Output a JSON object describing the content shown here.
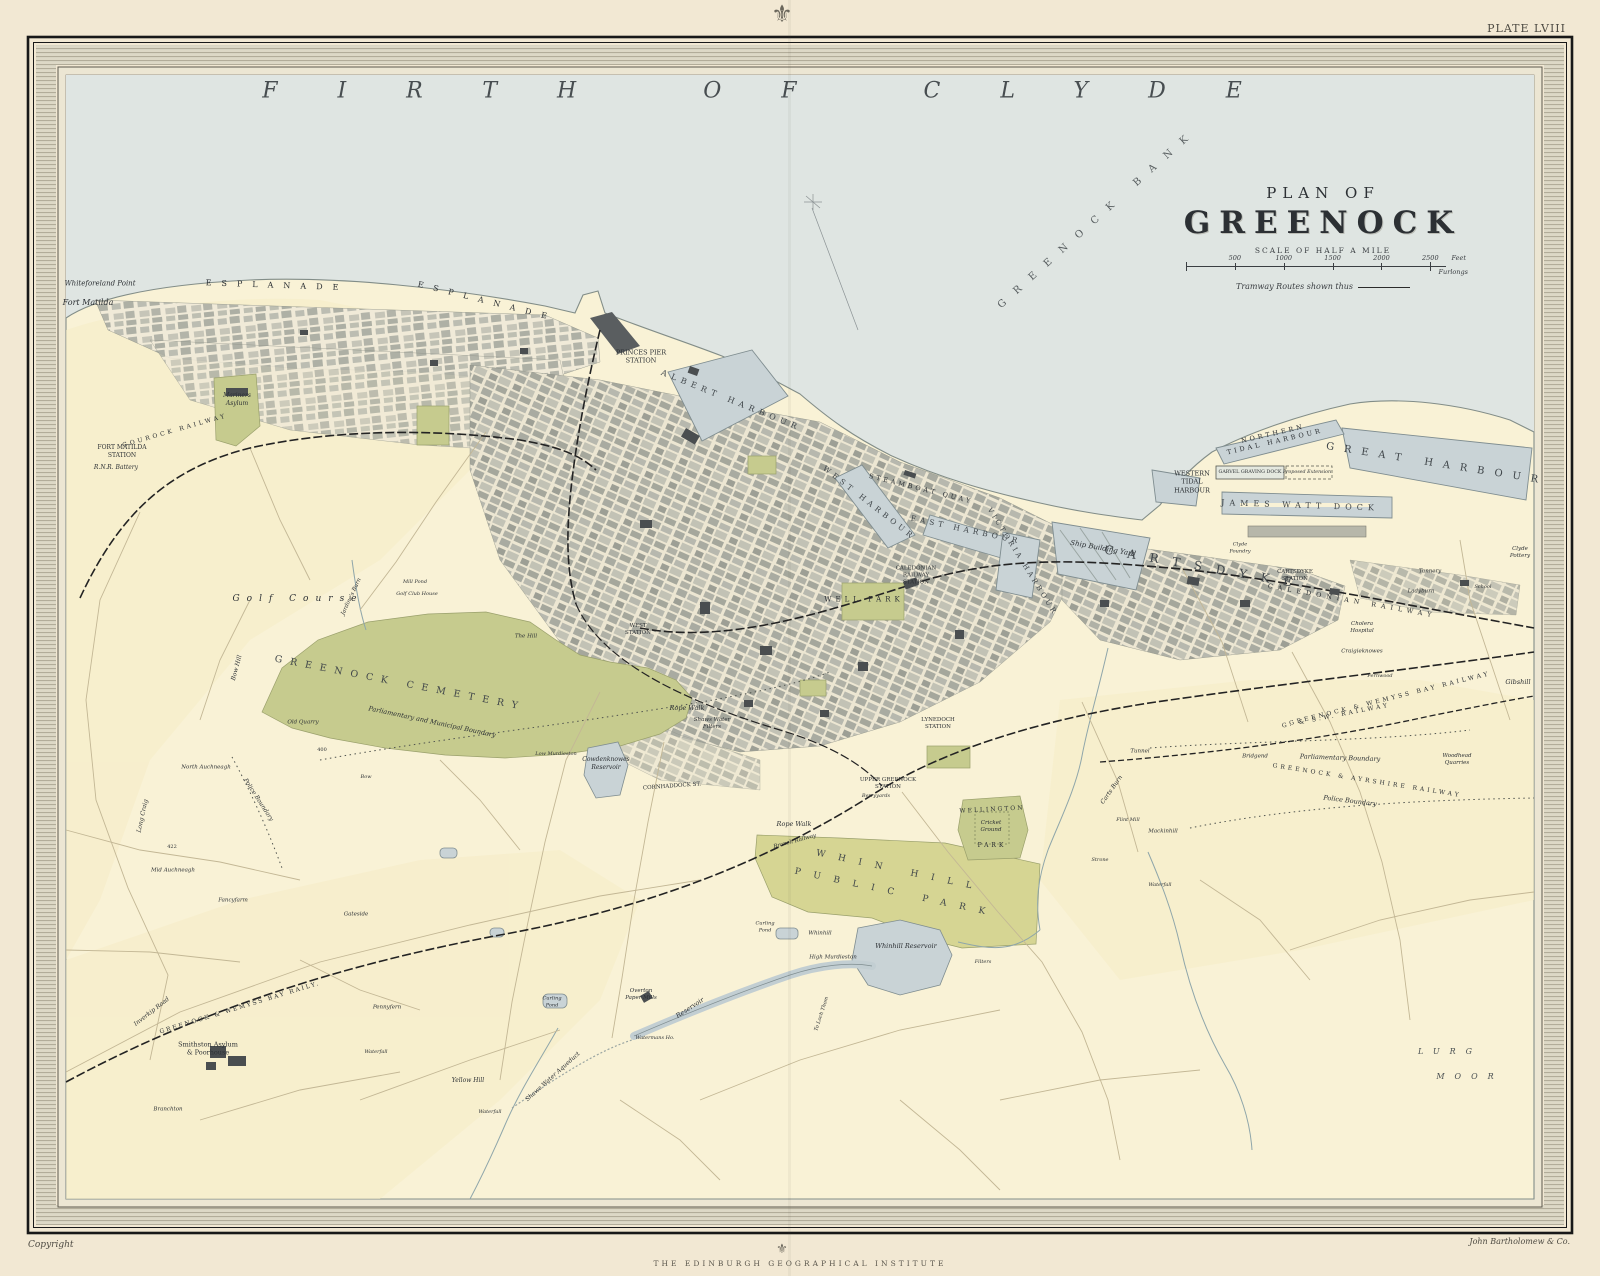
{
  "page": {
    "plate": "PLATE LVIII",
    "copyright": "Copyright",
    "publisher": "John Bartholomew & Co.",
    "institute": "THE EDINBURGH GEOGRAPHICAL INSTITUTE",
    "crest_glyph": "⚜"
  },
  "title": {
    "kicker": "PLAN OF",
    "name": "GREENOCK",
    "scale_caption": "SCALE OF HALF A MILE",
    "scale_ticks": [
      "500",
      "1000",
      "1500",
      "2000",
      "2500"
    ],
    "scale_unit_top": "Feet",
    "scale_unit_bottom": "Furlongs",
    "tramway_note": "Tramway Routes shown thus"
  },
  "colors": {
    "paper": "#f2e8d3",
    "margin_band": "#d8d3c1",
    "sea": "#dfe5e2",
    "land": "#f9f2d6",
    "land_warm": "#f6ecc6",
    "city_street": "#eee8d5",
    "green": "#c6cb8e",
    "green2": "#d6d593",
    "water": "#c9d3d6",
    "water_edge": "#7f8d90",
    "ink": "#2c3034",
    "ink_light": "#4a5052",
    "rail": "#232323",
    "road": "#c3b795"
  },
  "map": {
    "labels": [
      {
        "t": "FIRTH OF CLYDE",
        "x": 782,
        "y": 92,
        "s": 22,
        "ls": 60,
        "i": true,
        "c": "#474d50"
      },
      {
        "t": "GREENOCK BANK",
        "x": 1098,
        "y": 218,
        "s": 10,
        "ls": 13,
        "r": -42,
        "c": "#565c5e"
      },
      {
        "t": "Whiteforeland Point",
        "x": 100,
        "y": 284,
        "s": 7,
        "i": true
      },
      {
        "t": "Fort Matilda",
        "x": 88,
        "y": 303,
        "s": 8,
        "i": true
      },
      {
        "t": "ESPLANADE",
        "x": 277,
        "y": 286,
        "s": 8,
        "ls": 10,
        "r": 2
      },
      {
        "t": "ESPLANADE",
        "x": 487,
        "y": 302,
        "s": 8,
        "ls": 10,
        "r": 14
      },
      {
        "t": "Mariners|Asylum",
        "x": 237,
        "y": 400,
        "s": 6,
        "i": true
      },
      {
        "t": "FORT MATILDA|STATION",
        "x": 122,
        "y": 452,
        "s": 6
      },
      {
        "t": "R.N.R. Battery",
        "x": 116,
        "y": 468,
        "s": 6,
        "i": true
      },
      {
        "t": "GOUROCK RAILWAY",
        "x": 175,
        "y": 431,
        "s": 6,
        "ls": 3,
        "r": -16
      },
      {
        "t": "PRINCES PIER|STATION",
        "x": 641,
        "y": 357,
        "s": 6.5
      },
      {
        "t": "ALBERT HARBOUR",
        "x": 731,
        "y": 401,
        "s": 8,
        "ls": 5,
        "r": 22,
        "c": "#3f4549"
      },
      {
        "t": "WEST HARBOUR",
        "x": 869,
        "y": 503,
        "s": 7.5,
        "ls": 4,
        "r": 38,
        "c": "#3f4549"
      },
      {
        "t": "STEAMBOAT QUAY",
        "x": 921,
        "y": 489,
        "s": 6.5,
        "ls": 3,
        "r": 14
      },
      {
        "t": "EAST HARBOUR",
        "x": 966,
        "y": 530,
        "s": 7.5,
        "ls": 4,
        "r": 12,
        "c": "#3f4549"
      },
      {
        "t": "VICTORIA HARBOUR",
        "x": 1022,
        "y": 562,
        "s": 7,
        "ls": 3,
        "r": 58,
        "c": "#3f4549"
      },
      {
        "t": "CALEDONIAN|RAILWAY|STATION",
        "x": 916,
        "y": 576,
        "s": 5.5
      },
      {
        "t": "WELL PARK",
        "x": 864,
        "y": 600,
        "s": 7,
        "ls": 4
      },
      {
        "t": "Ship Building Yard",
        "x": 1103,
        "y": 549,
        "s": 7,
        "i": true,
        "r": 10
      },
      {
        "t": "CARTSDYKE",
        "x": 1205,
        "y": 568,
        "s": 12,
        "ls": 14,
        "r": 10,
        "c": "#3f4549"
      },
      {
        "t": "CARTSDYKE|STATION",
        "x": 1295,
        "y": 576,
        "s": 5.5
      },
      {
        "t": "CALEDONIAN RAILWAY",
        "x": 1352,
        "y": 601,
        "s": 6.5,
        "ls": 5,
        "r": 10
      },
      {
        "t": "JAMES WATT DOCK",
        "x": 1300,
        "y": 506,
        "s": 8,
        "ls": 5,
        "r": 2,
        "c": "#3f4549"
      },
      {
        "t": "GREAT HARBOUR",
        "x": 1437,
        "y": 464,
        "s": 10,
        "ls": 10,
        "r": 9,
        "c": "#3f4549"
      },
      {
        "t": "NORTHERN|TIDAL HARBOUR",
        "x": 1274,
        "y": 438,
        "s": 6.5,
        "ls": 3,
        "r": -13
      },
      {
        "t": "WESTERN|TIDAL|HARBOUR",
        "x": 1192,
        "y": 482,
        "s": 6.5
      },
      {
        "t": "GARVEL GRAVING DOCK",
        "x": 1250,
        "y": 473,
        "s": 4.8
      },
      {
        "t": "Proposed Extension",
        "x": 1307,
        "y": 473,
        "s": 4.8,
        "i": true
      },
      {
        "t": "Clyde|Pottery",
        "x": 1520,
        "y": 553,
        "s": 5.5,
        "i": true
      },
      {
        "t": "Clyde|Foundry",
        "x": 1240,
        "y": 548,
        "s": 5,
        "i": true
      },
      {
        "t": "Tannery",
        "x": 1430,
        "y": 572,
        "s": 5.5,
        "i": true
      },
      {
        "t": "School",
        "x": 1483,
        "y": 587,
        "s": 5,
        "i": true
      },
      {
        "t": "Ladyburn",
        "x": 1421,
        "y": 592,
        "s": 5.5,
        "i": true
      },
      {
        "t": "Gibshill",
        "x": 1518,
        "y": 682,
        "s": 6.5,
        "i": true
      },
      {
        "t": "WEST|STATION",
        "x": 638,
        "y": 630,
        "s": 5.5
      },
      {
        "t": "LYNEDOCH|STATION",
        "x": 938,
        "y": 724,
        "s": 5.5
      },
      {
        "t": "UPPER GREENOCK|STATION",
        "x": 888,
        "y": 784,
        "s": 5.5
      },
      {
        "t": "Shaws Water|Filters",
        "x": 712,
        "y": 724,
        "s": 5.5,
        "i": true
      },
      {
        "t": "Cowdenknowes|Reservoir",
        "x": 606,
        "y": 764,
        "s": 6,
        "i": true
      },
      {
        "t": "CORNHADDOCK ST.",
        "x": 672,
        "y": 787,
        "s": 5.5,
        "r": -4
      },
      {
        "t": "Rope Walk",
        "x": 687,
        "y": 708,
        "s": 6.5,
        "i": true
      },
      {
        "t": "Rope Walk",
        "x": 794,
        "y": 824,
        "s": 6.5,
        "i": true
      },
      {
        "t": "WELLINGTON",
        "x": 992,
        "y": 810,
        "s": 6,
        "ls": 2,
        "r": -3
      },
      {
        "t": "Cricket|Ground",
        "x": 991,
        "y": 827,
        "s": 5.5,
        "i": true
      },
      {
        "t": "PARK",
        "x": 992,
        "y": 846,
        "s": 6,
        "ls": 3
      },
      {
        "t": "WHIN HILL",
        "x": 900,
        "y": 872,
        "s": 9,
        "ls": 13,
        "r": 12,
        "c": "#3f4549"
      },
      {
        "t": "PUBLIC PARK",
        "x": 896,
        "y": 894,
        "s": 9,
        "ls": 13,
        "r": 12,
        "c": "#3f4549"
      },
      {
        "t": "Whinhill Reservoir",
        "x": 906,
        "y": 946,
        "s": 6.5,
        "i": true
      },
      {
        "t": "Whinhill",
        "x": 820,
        "y": 934,
        "s": 5.5,
        "i": true
      },
      {
        "t": "High Murdieston",
        "x": 833,
        "y": 958,
        "s": 5.5,
        "i": true
      },
      {
        "t": "Filters",
        "x": 983,
        "y": 962,
        "s": 5,
        "i": true
      },
      {
        "t": "Branch Railway",
        "x": 795,
        "y": 842,
        "s": 5.5,
        "i": true,
        "r": -15
      },
      {
        "t": "Berryyards",
        "x": 876,
        "y": 796,
        "s": 5,
        "i": true
      },
      {
        "t": "Golf Course",
        "x": 298,
        "y": 600,
        "s": 9,
        "ls": 7,
        "i": true
      },
      {
        "t": "GREENOCK CEMETERY",
        "x": 400,
        "y": 684,
        "s": 9.5,
        "ls": 8,
        "r": 11,
        "c": "#3f4549"
      },
      {
        "t": "Parliamentary and Municipal Boundary",
        "x": 432,
        "y": 722,
        "s": 6.5,
        "i": true,
        "r": 12
      },
      {
        "t": "Jardine's Burn",
        "x": 352,
        "y": 597,
        "s": 5.5,
        "i": true,
        "r": -65
      },
      {
        "t": "Mill Pond",
        "x": 415,
        "y": 582,
        "s": 5,
        "i": true
      },
      {
        "t": "Golf Club House",
        "x": 417,
        "y": 594,
        "s": 5,
        "i": true
      },
      {
        "t": "The Hill",
        "x": 526,
        "y": 637,
        "s": 5.5,
        "i": true
      },
      {
        "t": "Bow Hill",
        "x": 237,
        "y": 668,
        "s": 6,
        "i": true,
        "r": -75
      },
      {
        "t": "Old Quarry",
        "x": 303,
        "y": 723,
        "s": 5.5,
        "i": true
      },
      {
        "t": "400",
        "x": 322,
        "y": 750,
        "s": 5
      },
      {
        "t": "North Auchneagh",
        "x": 206,
        "y": 768,
        "s": 5.5,
        "i": true
      },
      {
        "t": "Police Boundary",
        "x": 258,
        "y": 800,
        "s": 6,
        "i": true,
        "r": 57
      },
      {
        "t": "Long Craig",
        "x": 143,
        "y": 816,
        "s": 6,
        "i": true,
        "r": -78
      },
      {
        "t": "422",
        "x": 172,
        "y": 847,
        "s": 5
      },
      {
        "t": "Mid Auchneagh",
        "x": 173,
        "y": 871,
        "s": 5.5,
        "i": true
      },
      {
        "t": "Fancyfarm",
        "x": 233,
        "y": 901,
        "s": 5.5,
        "i": true
      },
      {
        "t": "Gateside",
        "x": 356,
        "y": 915,
        "s": 5.5,
        "i": true
      },
      {
        "t": "Bow",
        "x": 366,
        "y": 777,
        "s": 5,
        "i": true
      },
      {
        "t": "Low Murdieston",
        "x": 556,
        "y": 754,
        "s": 5,
        "i": true
      },
      {
        "t": "Inverkip Road",
        "x": 152,
        "y": 1012,
        "s": 6,
        "i": true,
        "r": -38
      },
      {
        "t": "GREENOCK & WEMYSS BAY RAILY.",
        "x": 240,
        "y": 1008,
        "s": 6,
        "ls": 2,
        "r": -17
      },
      {
        "t": "Smithston Asylum|& Poorhouse",
        "x": 208,
        "y": 1049,
        "s": 6.5
      },
      {
        "t": "Branchton",
        "x": 168,
        "y": 1110,
        "s": 5.5,
        "i": true
      },
      {
        "t": "Pennyfern",
        "x": 387,
        "y": 1008,
        "s": 5.5,
        "i": true
      },
      {
        "t": "Waterfall",
        "x": 376,
        "y": 1052,
        "s": 5,
        "i": true
      },
      {
        "t": "Yellow Hill",
        "x": 468,
        "y": 1081,
        "s": 6,
        "i": true
      },
      {
        "t": "Waterfall",
        "x": 490,
        "y": 1112,
        "s": 5,
        "i": true
      },
      {
        "t": "Curling|Pond",
        "x": 552,
        "y": 1002,
        "s": 5,
        "i": true
      },
      {
        "t": "Overton|Paper Mills",
        "x": 641,
        "y": 995,
        "s": 5.5,
        "i": true
      },
      {
        "t": "Reservoir",
        "x": 690,
        "y": 1008,
        "s": 6.5,
        "i": true,
        "r": -33
      },
      {
        "t": "Shaws Water Aqueduct",
        "x": 553,
        "y": 1077,
        "s": 6,
        "i": true,
        "r": -42
      },
      {
        "t": "Watermans Ho.",
        "x": 655,
        "y": 1038,
        "s": 5,
        "i": true
      },
      {
        "t": "To Loch Thom",
        "x": 822,
        "y": 1014,
        "s": 5,
        "i": true,
        "r": -72
      },
      {
        "t": "Curling|Pond",
        "x": 765,
        "y": 927,
        "s": 5,
        "i": true
      },
      {
        "t": "G. & S.W. RAILWAY",
        "x": 1336,
        "y": 716,
        "s": 6,
        "ls": 3,
        "r": -11
      },
      {
        "t": "GREENOCK & WEMYSS BAY RAILWAY",
        "x": 1390,
        "y": 699,
        "s": 6,
        "ls": 3,
        "r": -14
      },
      {
        "t": "GREENOCK & AYRSHIRE RAILWAY",
        "x": 1367,
        "y": 781,
        "s": 6,
        "ls": 3,
        "r": 9
      },
      {
        "t": "Parliamentary Boundary",
        "x": 1340,
        "y": 758,
        "s": 6.5,
        "i": true,
        "r": 2
      },
      {
        "t": "Police Boundary",
        "x": 1350,
        "y": 801,
        "s": 6.5,
        "i": true,
        "r": 7
      },
      {
        "t": "Bridgend",
        "x": 1255,
        "y": 757,
        "s": 5.5,
        "i": true
      },
      {
        "t": "Tunnel",
        "x": 1140,
        "y": 752,
        "s": 5.5,
        "i": true
      },
      {
        "t": "Woodhead|Quarries",
        "x": 1457,
        "y": 760,
        "s": 5.5,
        "i": true
      },
      {
        "t": "Cholera|Hospital",
        "x": 1362,
        "y": 628,
        "s": 5.5,
        "i": true
      },
      {
        "t": "Craigieknowes",
        "x": 1362,
        "y": 652,
        "s": 5.5,
        "i": true
      },
      {
        "t": "Fernwood",
        "x": 1380,
        "y": 676,
        "s": 5,
        "i": true
      },
      {
        "t": "Flint Mill",
        "x": 1128,
        "y": 820,
        "s": 5,
        "i": true
      },
      {
        "t": "Strone",
        "x": 1100,
        "y": 860,
        "s": 5,
        "i": true
      },
      {
        "t": "Mackinhill",
        "x": 1163,
        "y": 832,
        "s": 5.5,
        "i": true
      },
      {
        "t": "Waterfall",
        "x": 1160,
        "y": 885,
        "s": 5,
        "i": true
      },
      {
        "t": "Carts Burn",
        "x": 1112,
        "y": 790,
        "s": 6,
        "i": true,
        "r": -55
      },
      {
        "t": "LURG",
        "x": 1450,
        "y": 1052,
        "s": 8,
        "ls": 10,
        "i": true,
        "c": "#4a5052"
      },
      {
        "t": "MOOR",
        "x": 1470,
        "y": 1077,
        "s": 8,
        "ls": 10,
        "i": true,
        "c": "#4a5052"
      }
    ]
  }
}
